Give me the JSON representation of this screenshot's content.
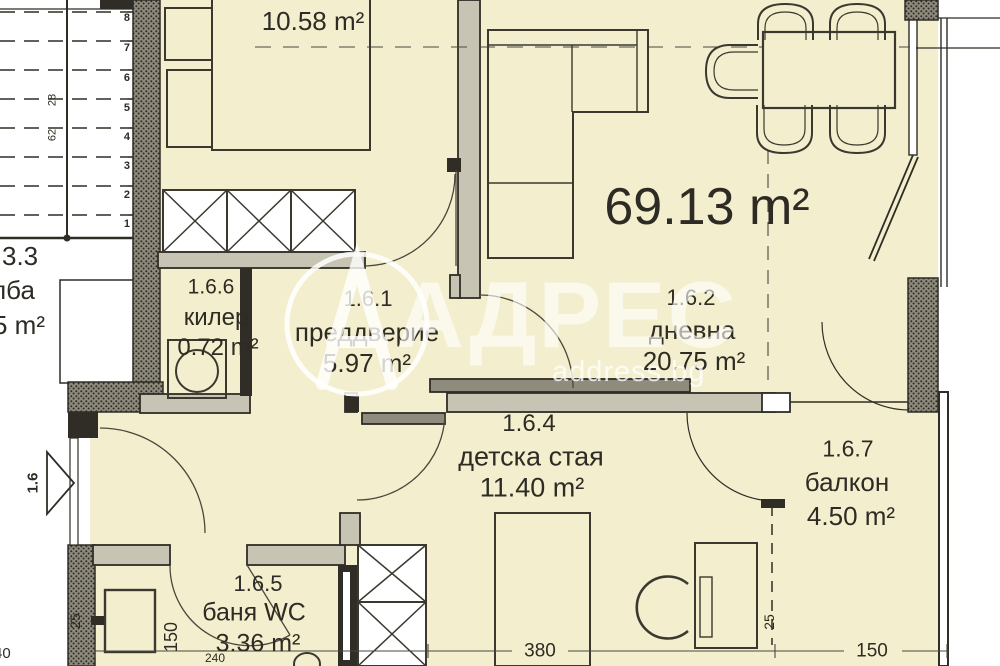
{
  "colors": {
    "floor_cream": "#f3efce",
    "wall_gray": "#c7c4b4",
    "line_dark": "#2f2d26",
    "paper_white": "#ffffff"
  },
  "watermark": {
    "brand": "АДРЕС",
    "site": "address.bg"
  },
  "plan": {
    "total_area": "69.13 m²",
    "rooms": {
      "bedroom": {
        "area": "10.58 m²"
      },
      "vestibule": {
        "code": "1.6.1",
        "name": "преддверие",
        "area": "5.97 m²"
      },
      "living": {
        "code": "1.6.2",
        "name": "дневна",
        "area": "20.75 m²"
      },
      "children": {
        "code": "1.6.4",
        "name": "детска стая",
        "area": "11.40 m²"
      },
      "bathroom": {
        "code": "1.6.5",
        "name": "баня WC",
        "area": "3.36 m²"
      },
      "closet": {
        "code": "1.6.6",
        "name": "килер",
        "area": "0.72 m²"
      },
      "balcony": {
        "code": "1.6.7",
        "name": "балкон",
        "area": "4.50 m²"
      }
    },
    "stairwell": {
      "code": "3.3",
      "name_fragment": "лба",
      "area_fragment": "5 m²",
      "dim_a": "28",
      "dim_b": "62",
      "steps": [
        "1",
        "2",
        "3",
        "4",
        "5",
        "6",
        "7",
        "8"
      ]
    },
    "entrance_label": "1.6",
    "dimensions": {
      "children_width": "380",
      "balcony_width": "150",
      "balcony_inset": "25",
      "bath_door_width": "150",
      "bath_width": "240",
      "entry_wall": "25",
      "edge_fragment": "40"
    }
  }
}
